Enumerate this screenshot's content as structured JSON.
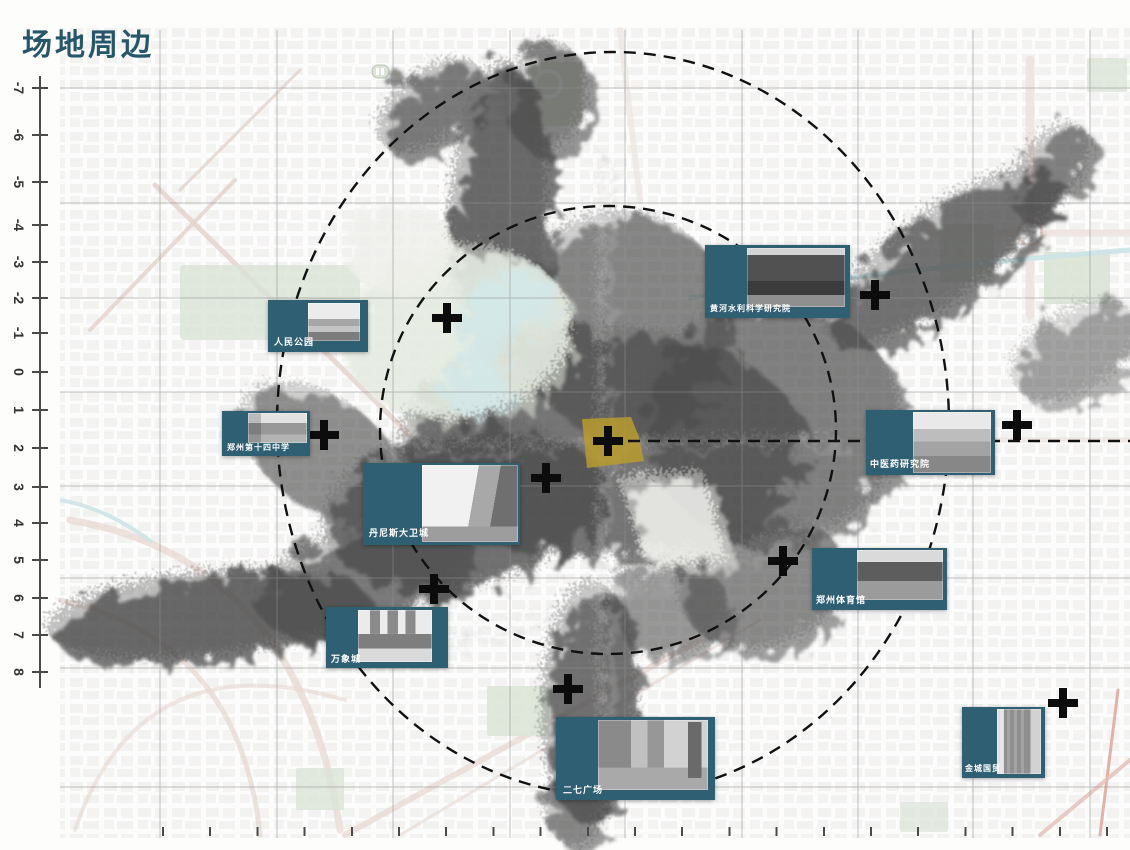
{
  "title": "场地周边",
  "axis": {
    "left_labels": [
      "-7",
      "-6",
      "-5",
      "-4",
      "-3",
      "-2",
      "-1",
      "0",
      "1",
      "2",
      "3",
      "4",
      "5",
      "6",
      "7",
      "8"
    ]
  },
  "landmarks": [
    {
      "label": "人民公园"
    },
    {
      "label": "郑州第十四中学"
    },
    {
      "label": "丹尼斯大卫城"
    },
    {
      "label": "万象城"
    },
    {
      "label": "二七广场"
    },
    {
      "label": "黄河水利科学研究院"
    },
    {
      "label": "中医药研究院"
    },
    {
      "label": "郑州体育馆"
    },
    {
      "label": "金城国贸"
    }
  ],
  "colors": {
    "card_teal": "#2f5f73",
    "title_teal": "#27566b",
    "site_yellow": "#b89b2e",
    "ring_black": "#111111"
  }
}
